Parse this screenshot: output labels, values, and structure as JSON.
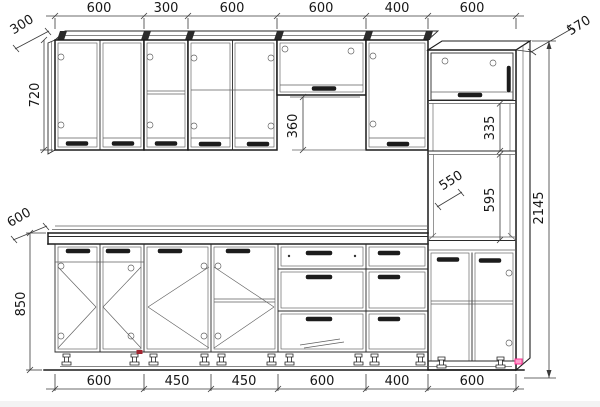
{
  "drawing": {
    "kind": "kitchen-cabinet-set-technical-drawing",
    "units": "mm",
    "background": "#ffffff",
    "line_color": "#1c1c1c",
    "accents": {
      "pink_marker": "#ff5fa8",
      "red_marker": "#a22430"
    },
    "dims": {
      "top_row": [
        "600",
        "300",
        "600",
        "600",
        "400",
        "600"
      ],
      "bottom_row": [
        "600",
        "450",
        "450",
        "600",
        "400",
        "600"
      ],
      "wall_depth": "300",
      "wall_height": "720",
      "short_cabinet_height": "360",
      "base_depth": "600",
      "base_height": "850",
      "tall_depth": "570",
      "tall_mid_section": "335",
      "niche_depth": "550",
      "niche_height": "595",
      "total_height": "2145"
    }
  }
}
